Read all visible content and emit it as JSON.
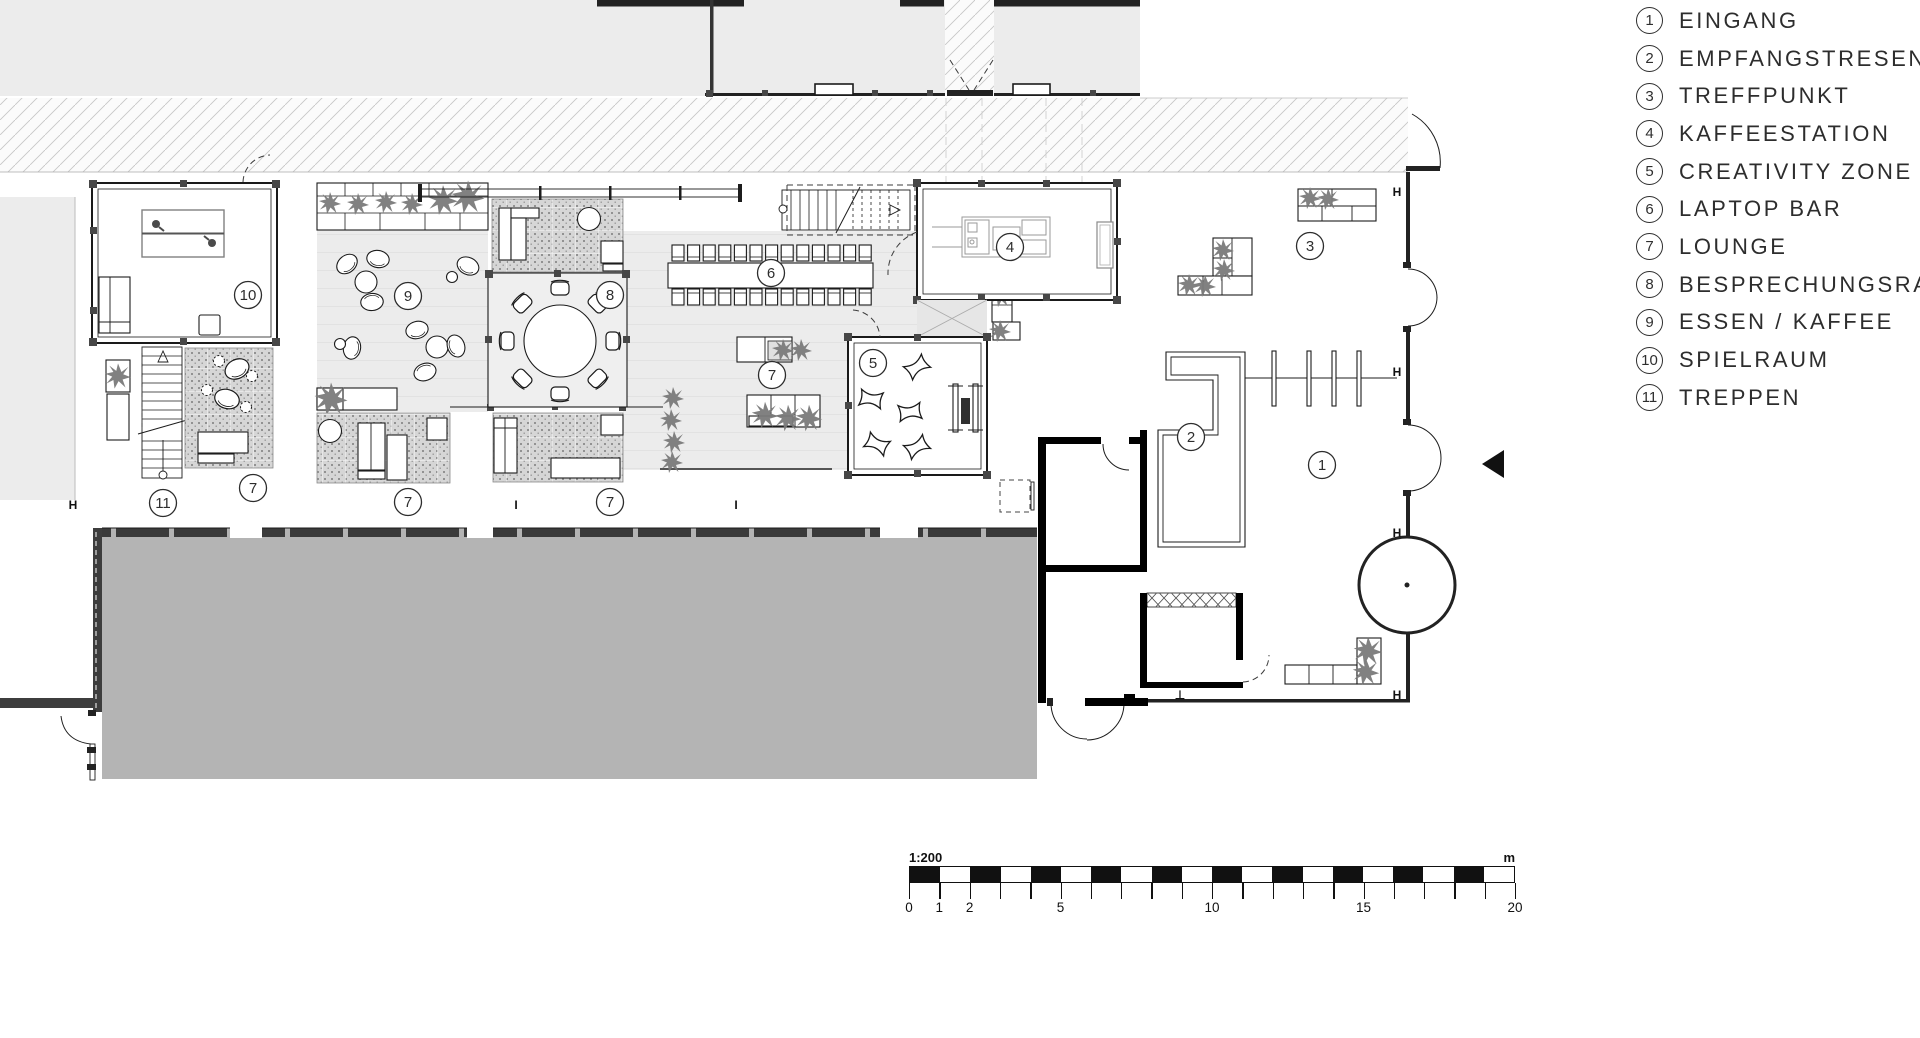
{
  "legend": {
    "items": [
      {
        "num": "1",
        "label": "EINGANG"
      },
      {
        "num": "2",
        "label": "EMPFANGSTRESEN"
      },
      {
        "num": "3",
        "label": "TREFFPUNKT"
      },
      {
        "num": "4",
        "label": "KAFFEESTATION"
      },
      {
        "num": "5",
        "label": "CREATIVITY ZONE"
      },
      {
        "num": "6",
        "label": "LAPTOP BAR"
      },
      {
        "num": "7",
        "label": "LOUNGE"
      },
      {
        "num": "8",
        "label": "BESPRECHUNGSRAUM"
      },
      {
        "num": "9",
        "label": "ESSEN / KAFFEE"
      },
      {
        "num": "10",
        "label": "SPIELRAUM"
      },
      {
        "num": "11",
        "label": "TREPPEN"
      }
    ]
  },
  "scale_bar": {
    "ratio_label": "1:200",
    "unit_label": "m",
    "total_meters": 20,
    "tick_labels": [
      0,
      1,
      2,
      5,
      10,
      15,
      20
    ]
  },
  "plan": {
    "room_markers": [
      {
        "num": "1",
        "x": 1322,
        "y": 465
      },
      {
        "num": "2",
        "x": 1191,
        "y": 437
      },
      {
        "num": "3",
        "x": 1310,
        "y": 246
      },
      {
        "num": "4",
        "x": 1010,
        "y": 247
      },
      {
        "num": "5",
        "x": 873,
        "y": 363
      },
      {
        "num": "6",
        "x": 771,
        "y": 273
      },
      {
        "num": "7",
        "x": 772,
        "y": 375
      },
      {
        "num": "7",
        "x": 253,
        "y": 488
      },
      {
        "num": "7",
        "x": 408,
        "y": 502
      },
      {
        "num": "7",
        "x": 610,
        "y": 502
      },
      {
        "num": "8",
        "x": 610,
        "y": 295
      },
      {
        "num": "9",
        "x": 408,
        "y": 296
      },
      {
        "num": "10",
        "x": 248,
        "y": 295
      },
      {
        "num": "11",
        "x": 163,
        "y": 503
      }
    ],
    "section_markers": [
      {
        "glyph": "H",
        "x": 73,
        "y": 509
      },
      {
        "glyph": "H",
        "x": 1397,
        "y": 196
      },
      {
        "glyph": "H",
        "x": 1397,
        "y": 376
      },
      {
        "glyph": "H",
        "x": 1397,
        "y": 537
      },
      {
        "glyph": "H",
        "x": 1397,
        "y": 699
      },
      {
        "glyph": "I",
        "x": 516,
        "y": 509
      },
      {
        "glyph": "I",
        "x": 736,
        "y": 509
      },
      {
        "glyph": "⊥",
        "x": 1180,
        "y": 699
      }
    ]
  },
  "colors": {
    "building_fill": "#ececec",
    "hall_fill": "#b4b4b4",
    "floor_fill": "#ececec",
    "stipple_fill": "#d6d6d6",
    "wall_dark": "#3d3d3d",
    "plant": "#7a7a7a",
    "line": "#1c1c1c"
  }
}
